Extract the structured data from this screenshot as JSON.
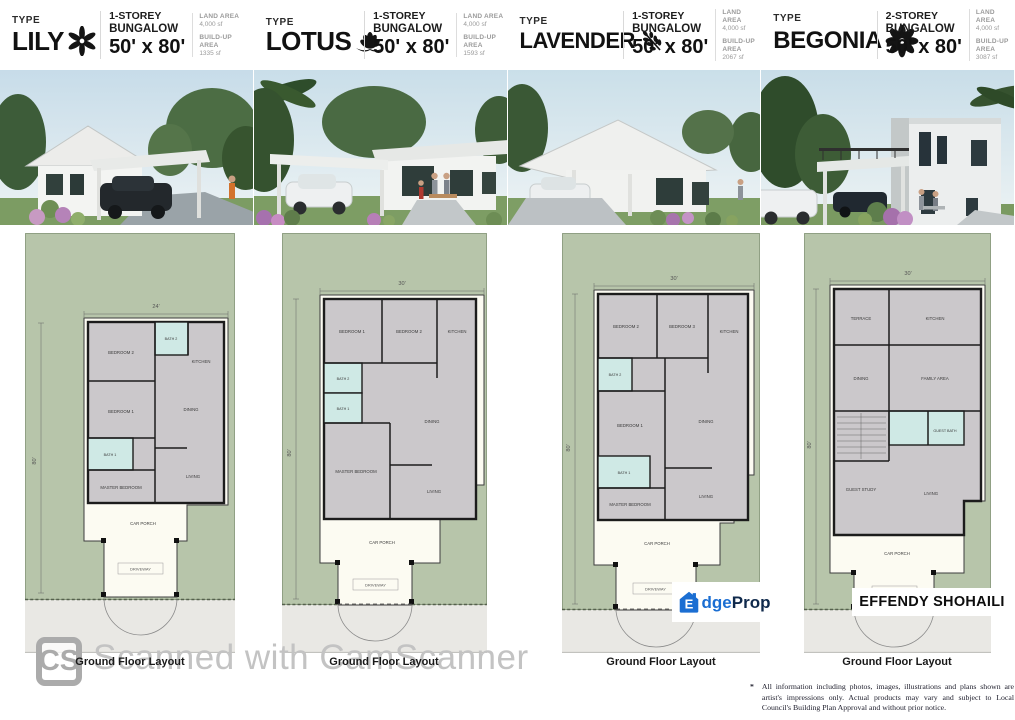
{
  "brand": {
    "edgeprop": {
      "house_letter": "E",
      "text_blue": "dge",
      "text_dark": "Prop",
      "blue": "#1b6ed2",
      "dark": "#102a4c"
    },
    "agent_name": "EFFENDY SHOHAILI"
  },
  "scanner": {
    "badge": "CS",
    "watermark": "Scanned with CamScanner"
  },
  "disclaimer": {
    "bullet": "*",
    "text": "All information including photos, images, illustrations and plans shown are artist's impressions only. Actual products may vary and subject to Local Council's Building Plan Approval and without prior notice."
  },
  "colors": {
    "lot_green": "#b7c5aa",
    "bath_cyan": "#cfe9e5",
    "floor_gray": "#cbc8cb",
    "outdoor_cream": "#fcfbf2",
    "road_gray": "#e9e8e4"
  },
  "houses": [
    {
      "type_label": "TYPE",
      "name": "LILY",
      "icon": "lily-flower-icon",
      "storey_line1": "1-STOREY",
      "storey_line2": "BUNGALOW",
      "lot_size": "50' x 80'",
      "land_area_label": "LAND AREA",
      "land_area_value": "4,000 sf",
      "buildup_area_label": "BUILD-UP AREA",
      "buildup_area_value": "1335 sf",
      "plan": {
        "caption": "Ground Floor Layout",
        "width_dim": "24'",
        "depth_dim": "80'",
        "rooms": {
          "bedroom2": "BEDROOM 2",
          "bath2": "BATH 2",
          "kitchen": "KITCHEN",
          "bedroom1": "BEDROOM 1",
          "dining": "DINING",
          "bath1": "BATH 1",
          "master": "MASTER BEDROOM",
          "living": "LIVING",
          "carporch": "CAR PORCH",
          "driveway": "DRIVEWAY"
        }
      }
    },
    {
      "type_label": "TYPE",
      "name": "LOTUS",
      "icon": "lotus-flower-icon",
      "storey_line1": "1-STOREY",
      "storey_line2": "BUNGALOW",
      "lot_size": "50' x 80'",
      "land_area_label": "LAND AREA",
      "land_area_value": "4,000 sf",
      "buildup_area_label": "BUILD-UP AREA",
      "buildup_area_value": "1593 sf",
      "plan": {
        "caption": "Ground Floor Layout",
        "width_dim": "30'",
        "depth_dim": "80'",
        "rooms": {
          "bedroom1": "BEDROOM 1",
          "bedroom2": "BEDROOM 2",
          "kitchen": "KITCHEN",
          "bath2": "BATH 2",
          "bath1": "BATH 1",
          "dining": "DINING",
          "master": "MASTER BEDROOM",
          "living": "LIVING",
          "carporch": "CAR PORCH",
          "driveway": "DRIVEWAY"
        }
      }
    },
    {
      "type_label": "TYPE",
      "name": "LAVENDER",
      "icon": "lavender-sprig-icon",
      "storey_line1": "1-STOREY",
      "storey_line2": "BUNGALOW",
      "lot_size": "50' x 80'",
      "land_area_label": "LAND AREA",
      "land_area_value": "4,000 sf",
      "buildup_area_label": "BUILD-UP AREA",
      "buildup_area_value": "2067 sf",
      "plan": {
        "caption": "Ground Floor Layout",
        "width_dim": "30'",
        "depth_dim": "80'",
        "rooms": {
          "bedroom2": "BEDROOM 2",
          "bedroom3": "BEDROOM 3",
          "kitchen": "KITCHEN",
          "bath2": "BATH 2",
          "bedroom1": "BEDROOM 1",
          "dining": "DINING",
          "bath1": "BATH 1",
          "master": "MASTER BEDROOM",
          "living": "LIVING",
          "carporch": "CAR PORCH",
          "driveway": "DRIVEWAY"
        }
      }
    },
    {
      "type_label": "TYPE",
      "name": "BEGONIA",
      "icon": "begonia-flower-icon",
      "storey_line1": "2-STOREY",
      "storey_line2": "BUNGALOW",
      "lot_size": "50' x 80'",
      "land_area_label": "LAND AREA",
      "land_area_value": "4,000 sf",
      "buildup_area_label": "BUILD-UP AREA",
      "buildup_area_value": "3087 sf",
      "plan": {
        "caption": "Ground Floor Layout",
        "width_dim": "30'",
        "depth_dim": "80'",
        "rooms": {
          "terrace": "TERRACE",
          "kitchen": "KITCHEN",
          "dining": "DINING",
          "family": "FAMILY AREA",
          "guestbath": "GUEST BATH",
          "gueststudy": "GUEST STUDY",
          "living": "LIVING",
          "carporch": "CAR PORCH",
          "driveway": "DRIVEWAY"
        }
      }
    }
  ]
}
